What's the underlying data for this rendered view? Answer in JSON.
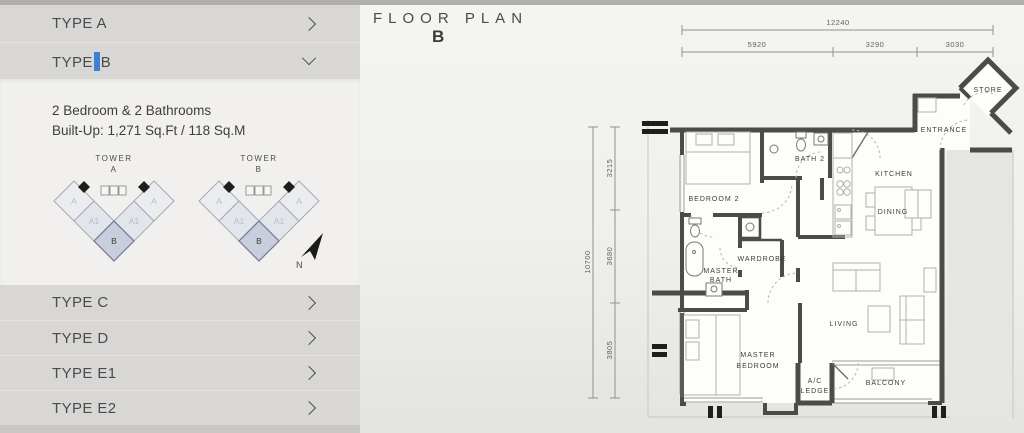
{
  "sidebar": {
    "types": [
      {
        "label": "TYPE A"
      },
      {
        "label_pre": "TYPE",
        "label_post": "B"
      },
      {
        "label": "TYPE C"
      },
      {
        "label": "TYPE D"
      },
      {
        "label": "TYPE E1"
      },
      {
        "label": "TYPE E2"
      }
    ],
    "details": {
      "line1": "2 Bedroom & 2 Bathrooms",
      "line2": "Built-Up: 1,271 Sq.Ft / 118 Sq.M"
    },
    "towers": [
      {
        "name": "TOWER",
        "letter": "A",
        "units": [
          "A",
          "A1",
          "B",
          "A1",
          "A"
        ]
      },
      {
        "name": "TOWER",
        "letter": "B",
        "units": [
          "A",
          "A1",
          "B",
          "A1",
          "A"
        ]
      }
    ],
    "north_label": "N",
    "icons": {
      "collapsed": "chevron-right",
      "expanded": "chevron-down"
    }
  },
  "floorplan": {
    "title": "FLOOR PLAN",
    "subtitle": "B",
    "dims_top": {
      "overall": "12240",
      "segments": [
        "5920",
        "3290",
        "3030"
      ]
    },
    "dims_left": {
      "overall": "10700",
      "segments": [
        "3215",
        "3680",
        "3805"
      ]
    },
    "rooms": {
      "store": "STORE",
      "entrance": "ENTRANCE",
      "bath2": "BATH 2",
      "kitchen": "KITCHEN",
      "bedroom2": "BEDROOM 2",
      "dining": "DINING",
      "wardrobe": "WARDROBE",
      "master_bath_1": "MASTER",
      "master_bath_2": "BATH",
      "living": "LIVING",
      "master_bedroom_1": "MASTER",
      "master_bedroom_2": "BEDROOM",
      "ac_ledge_1": "A/C",
      "ac_ledge_2": "LEDGE",
      "balcony": "BALCONY"
    }
  },
  "colors": {
    "cursor_accent": "#3f7fd6",
    "unit_b_fill": "#c8cede",
    "wall": "#4b4b49",
    "sidebar_gray": "#d8d7d5"
  }
}
